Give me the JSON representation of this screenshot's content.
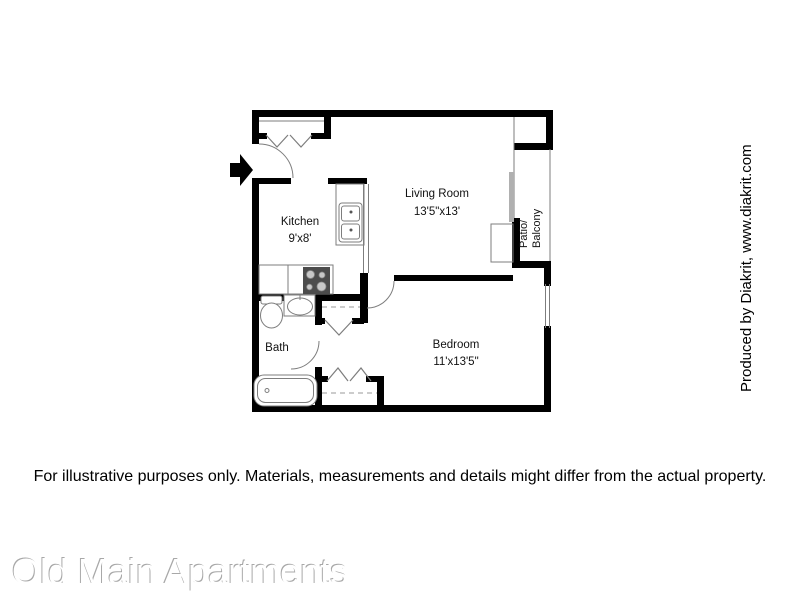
{
  "page": {
    "title": "Old Main Apartments",
    "disclaimer": "For illustrative purposes only.  Materials, measurements and details might differ from the actual property.",
    "producer_credit": "Produced by Diakrit, www.diakrit.com"
  },
  "floorplan": {
    "kitchen_label": "Kitchen",
    "kitchen_dims": "9'x8'",
    "living_room_label": "Living Room",
    "living_room_dims": "13'5\"x13'",
    "bedroom_label": "Bedroom",
    "bedroom_dims": "11'x13'5\"",
    "bath_label": "Bath",
    "patio_label_line1": "Patio/",
    "patio_label_line2": "Balcony"
  },
  "colors": {
    "wall": "#000000",
    "fixture_line": "#7d7d7d",
    "dashed_line": "#999999",
    "stove_body": "#4c4c4c",
    "burner": "#c8c8c8",
    "sliding_door": "#b0b0b0",
    "title_emboss_shadow": "#a8a8a8"
  }
}
